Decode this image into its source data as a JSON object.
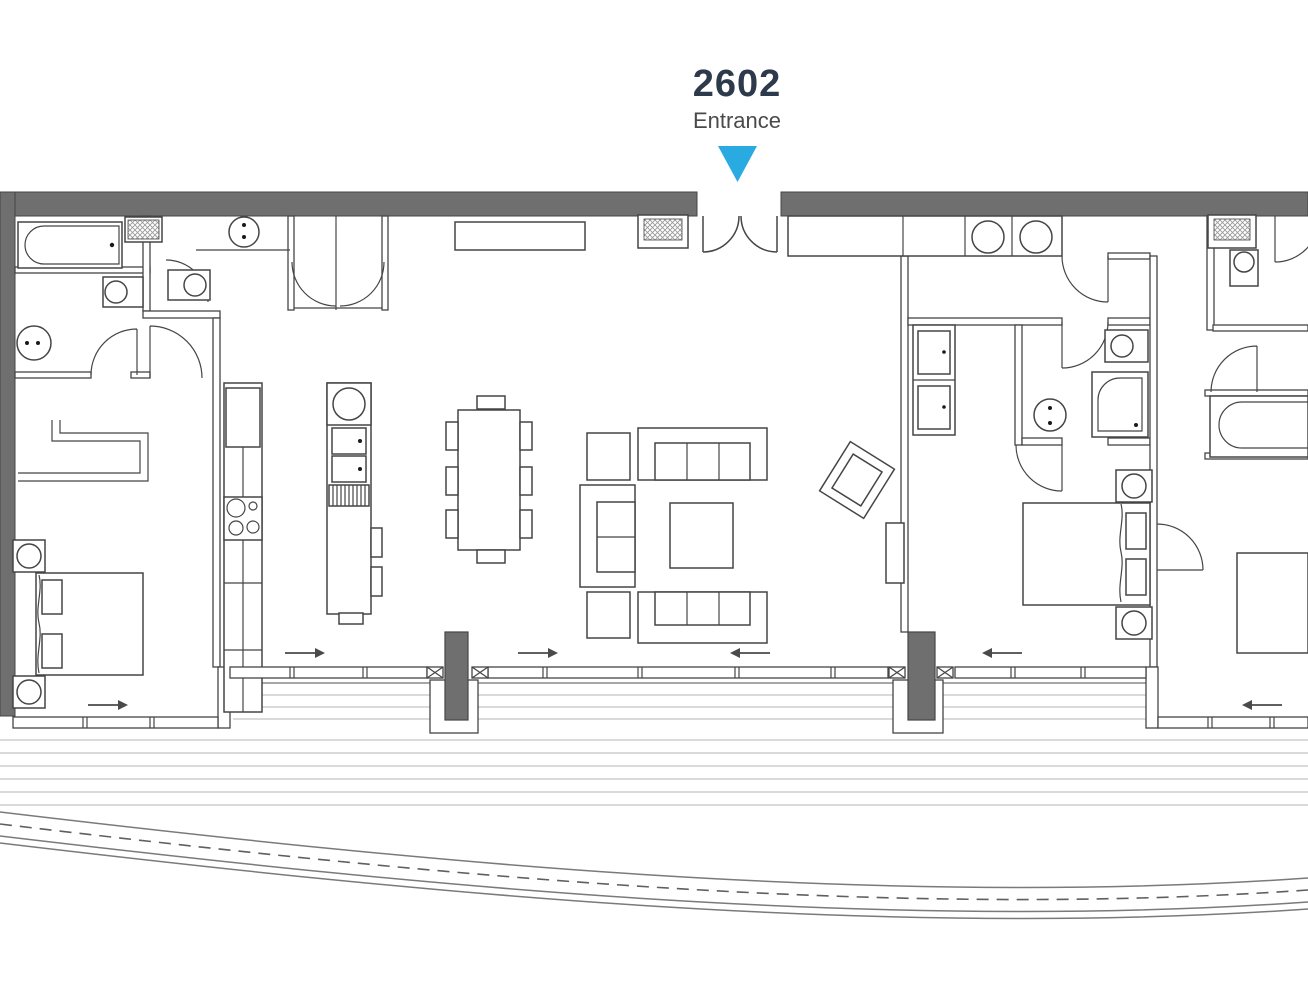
{
  "header": {
    "unit_number": "2602",
    "entrance_label": "Entrance"
  },
  "colors": {
    "accent": "#29ABE2",
    "wall_gray": "#6F6F6F",
    "line_dark": "#454545",
    "title_navy": "#2D3A4B",
    "subtitle_gray": "#4A4A4A"
  }
}
